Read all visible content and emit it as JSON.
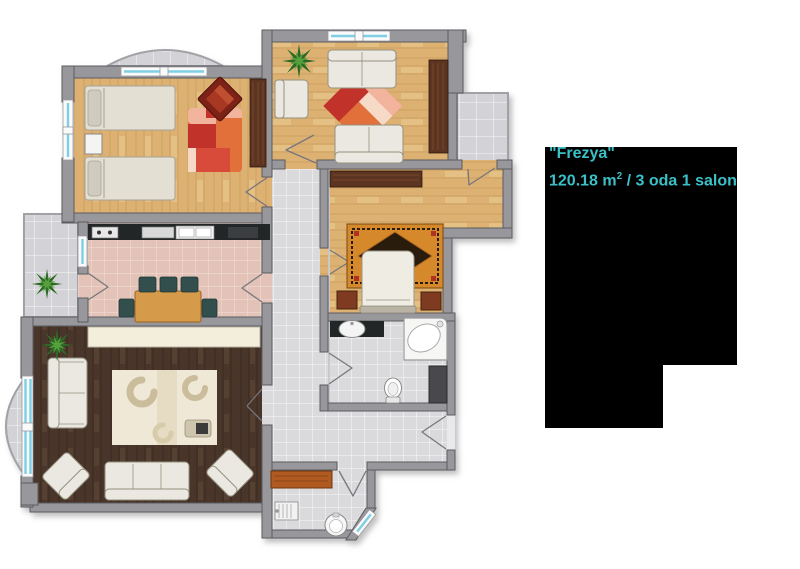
{
  "unit": {
    "name": "\"Frezya\"",
    "area": "120.18 m",
    "area_sup": "2",
    "area_rest": " / 3 oda 1 salon"
  },
  "colors": {
    "label_text": "#3bc0c8",
    "panel_bg": "#000000",
    "wall": "#98979c",
    "wall_edge": "#5b5b60",
    "wood_light": "#ddb172",
    "wood_grain": "#c09355",
    "wood_dark": "#4a362b",
    "wood_dark_grain": "#392920",
    "tile": "#dadadd",
    "tile_grout": "#f2f2f4",
    "balcony_tile": "#d3d3d7",
    "kitchen_tile": "#e3c3b8",
    "kitchen_grout": "#f0dbd2",
    "counter": "#232527",
    "sofa": "#eae8e0",
    "sofa_edge": "#95917f",
    "bed_cream": "#e3dfd2",
    "rug_red": "#d84b3a",
    "rug_red_light": "#f2b49c",
    "rug_red_dark": "#c0302a",
    "rug_orange": "#e2703a",
    "rug_persian": "#d5892b",
    "rug_persian_dark": "#2a1c0e",
    "furniture_brown": "#5c3420",
    "cabinet_orange": "#b05a20",
    "chair_teal": "#31504e",
    "table_wood": "#d69a4c",
    "plant_green": "#2e6b28",
    "plant_green_light": "#55a03c",
    "window_blue": "#7ecfe4",
    "window_frame": "#fafafa",
    "door_line": "#76767c",
    "living_rug": "#efe8d6",
    "living_rug_pattern": "#cbbd9b"
  }
}
